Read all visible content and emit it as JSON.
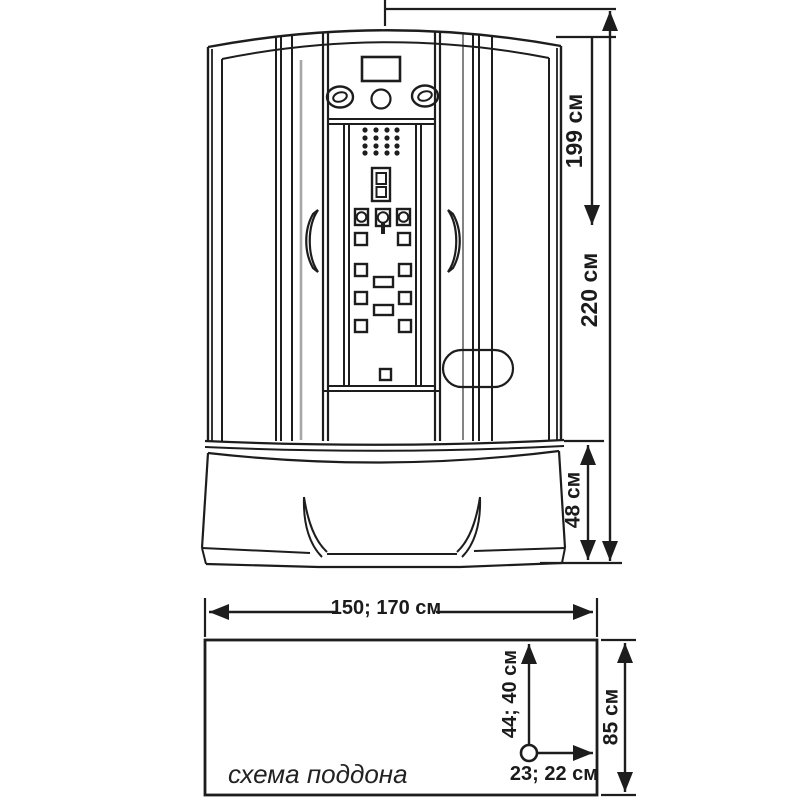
{
  "canvas": {
    "background": "#ffffff",
    "ink": "#1d1d1d"
  },
  "front_view": {
    "dim_cabin_height": "199 см",
    "dim_total_height": "220 см",
    "dim_base_height": "48 см"
  },
  "pan_scheme": {
    "caption": "схема поддона",
    "dim_width": "150; 170 см",
    "dim_depth": "85 см",
    "dim_drain_vertical": "44; 40 см",
    "dim_drain_horizontal": "23; 22 см"
  }
}
